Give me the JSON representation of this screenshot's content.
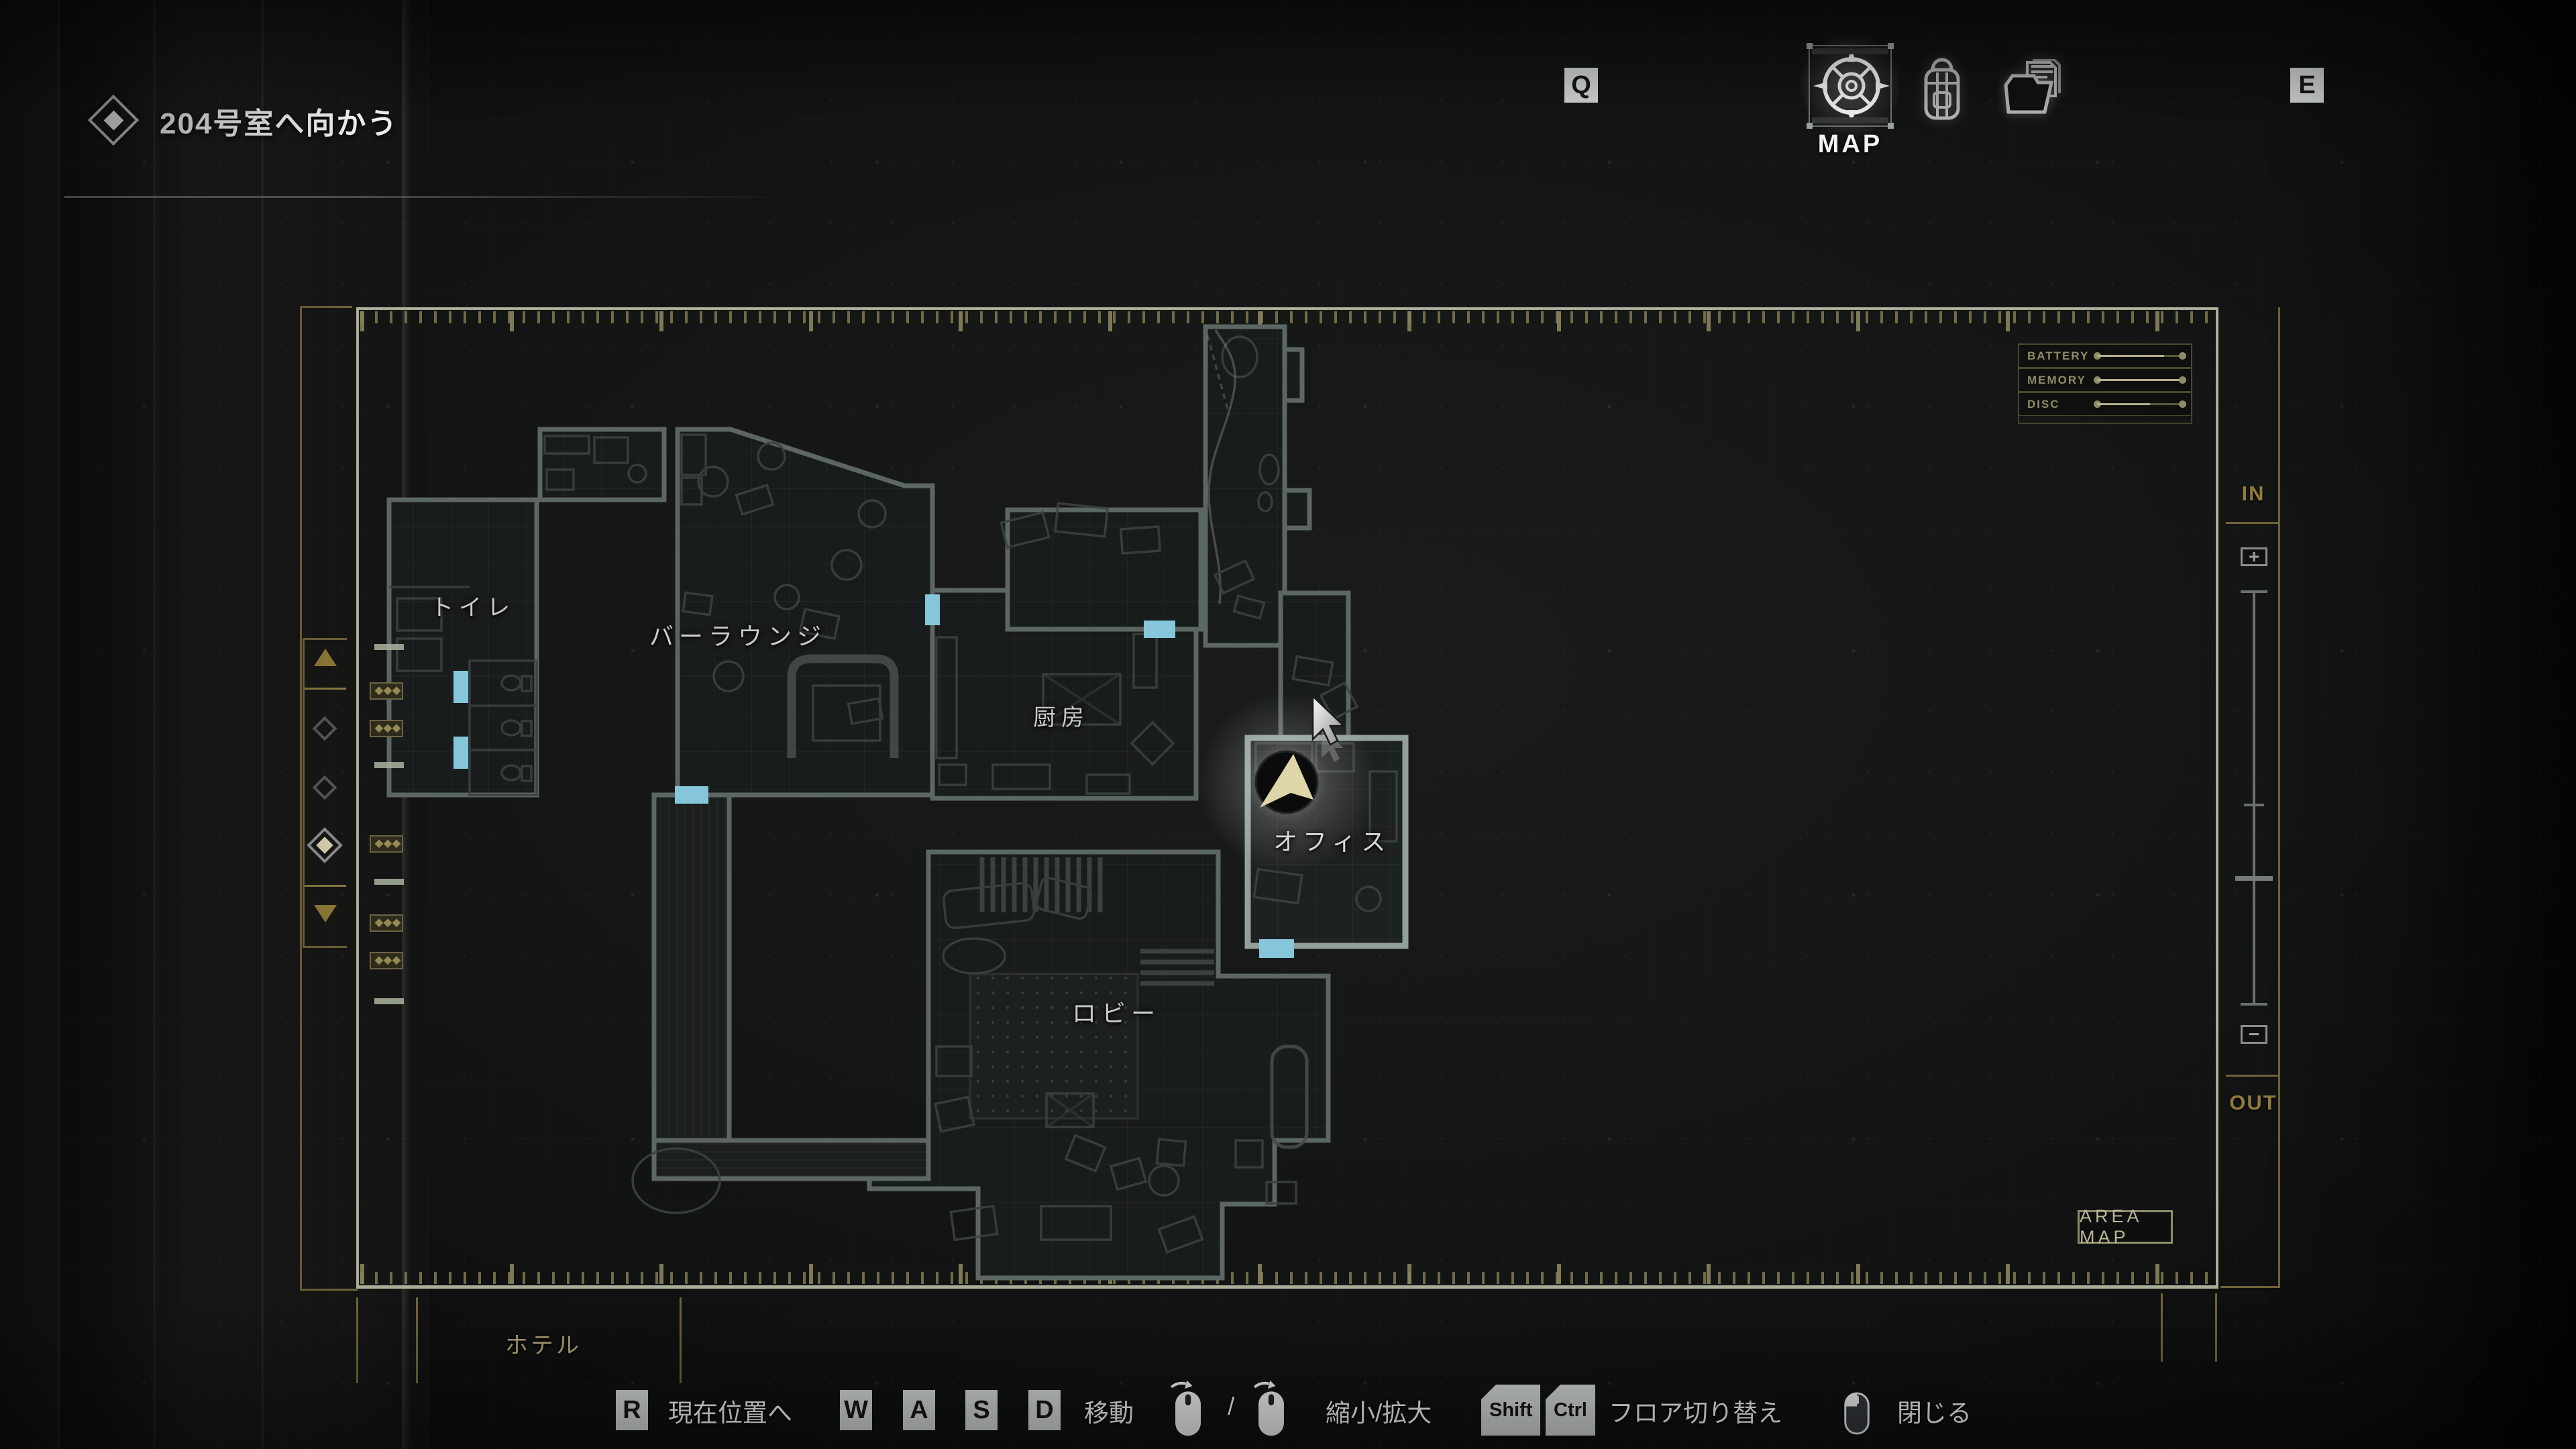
{
  "objective": {
    "text": "204号室へ向かう"
  },
  "tabs": {
    "key_prev": "Q",
    "key_next": "E",
    "map_label": "MAP"
  },
  "meters": {
    "rows": [
      {
        "label": "BATTERY",
        "value": 78
      },
      {
        "label": "MEMORY",
        "value": 100
      },
      {
        "label": "DISC",
        "value": 62
      }
    ]
  },
  "map": {
    "area_name": "ホテル",
    "area_map_button": "AREA MAP",
    "rooms": [
      {
        "label": "トイレ"
      },
      {
        "label": "バーラウンジ"
      },
      {
        "label": "厨房"
      },
      {
        "label": "オフィス"
      },
      {
        "label": "ロビー"
      }
    ]
  },
  "floor_selector": {
    "floor_count": 3,
    "selected_floor_index": 3
  },
  "zoom_control": {
    "in": "IN",
    "plus": "+",
    "minus": "−",
    "out": "OUT"
  },
  "controls": {
    "key_r": "R",
    "to_current_position": "現在位置へ",
    "key_w": "W",
    "key_a": "A",
    "key_s": "S",
    "key_d": "D",
    "move": "移動",
    "slash": "/",
    "zoom": "縮小/拡大",
    "key_shift": "Shift",
    "key_ctrl": "Ctrl",
    "floor_switch": "フロア切り替え",
    "close": "閉じる"
  },
  "colors": {
    "accent_gold": "#8a7b44",
    "cyan_door": "#85c6da",
    "marker_cream": "#ded6a8"
  }
}
